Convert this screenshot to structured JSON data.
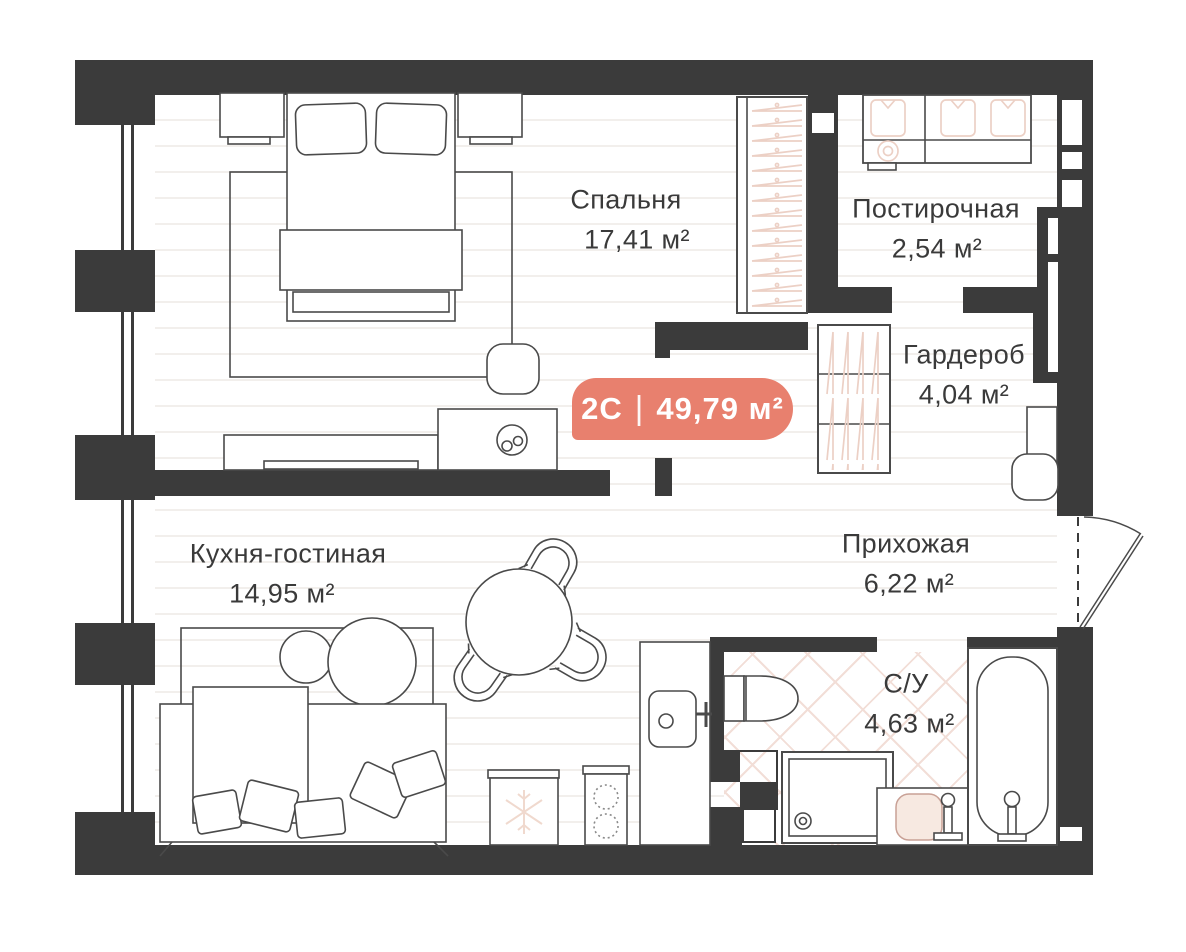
{
  "plan": {
    "badge": {
      "type": "2С",
      "divider": "|",
      "area": "49,79 м²",
      "color": "#E8806E"
    },
    "rooms": [
      {
        "id": "bedroom",
        "name": "Спальня",
        "area": "17,41 м²"
      },
      {
        "id": "laundry",
        "name": "Постирочная",
        "area": "2,54 м²"
      },
      {
        "id": "wardrobe",
        "name": "Гардероб",
        "area": "4,04 м²"
      },
      {
        "id": "hallway",
        "name": "Прихожая",
        "area": "6,22 м²"
      },
      {
        "id": "kitchen_living",
        "name": "Кухня-гостиная",
        "area": "14,95 м²"
      },
      {
        "id": "bathroom",
        "name": "С/У",
        "area": "4,63 м²"
      }
    ],
    "colors": {
      "wall": "#3B3B3B",
      "furniture_outline": "#4A4A4A",
      "accent_badge": "#E8806E",
      "accent_pink_details": "#ECD0C5",
      "bathroom_tile": "#F2DED7",
      "floor_stripe": "#F2EFEC"
    },
    "icons": [
      "bed-icon",
      "pillow-icon",
      "nightstand-icon",
      "rug-icon",
      "pouf-icon",
      "desk-icon",
      "tv-console-icon",
      "wardrobe-hangers-icon",
      "washer-dryer-icon",
      "shirt-icon",
      "dining-table-icon",
      "chair-icon",
      "sofa-icon",
      "fridge-snowflake-icon",
      "stove-icon",
      "kitchen-sink-icon",
      "toilet-icon",
      "shower-tray-icon",
      "vanity-sink-icon",
      "bathtub-icon",
      "entry-door-swing-icon",
      "window-icon"
    ]
  }
}
